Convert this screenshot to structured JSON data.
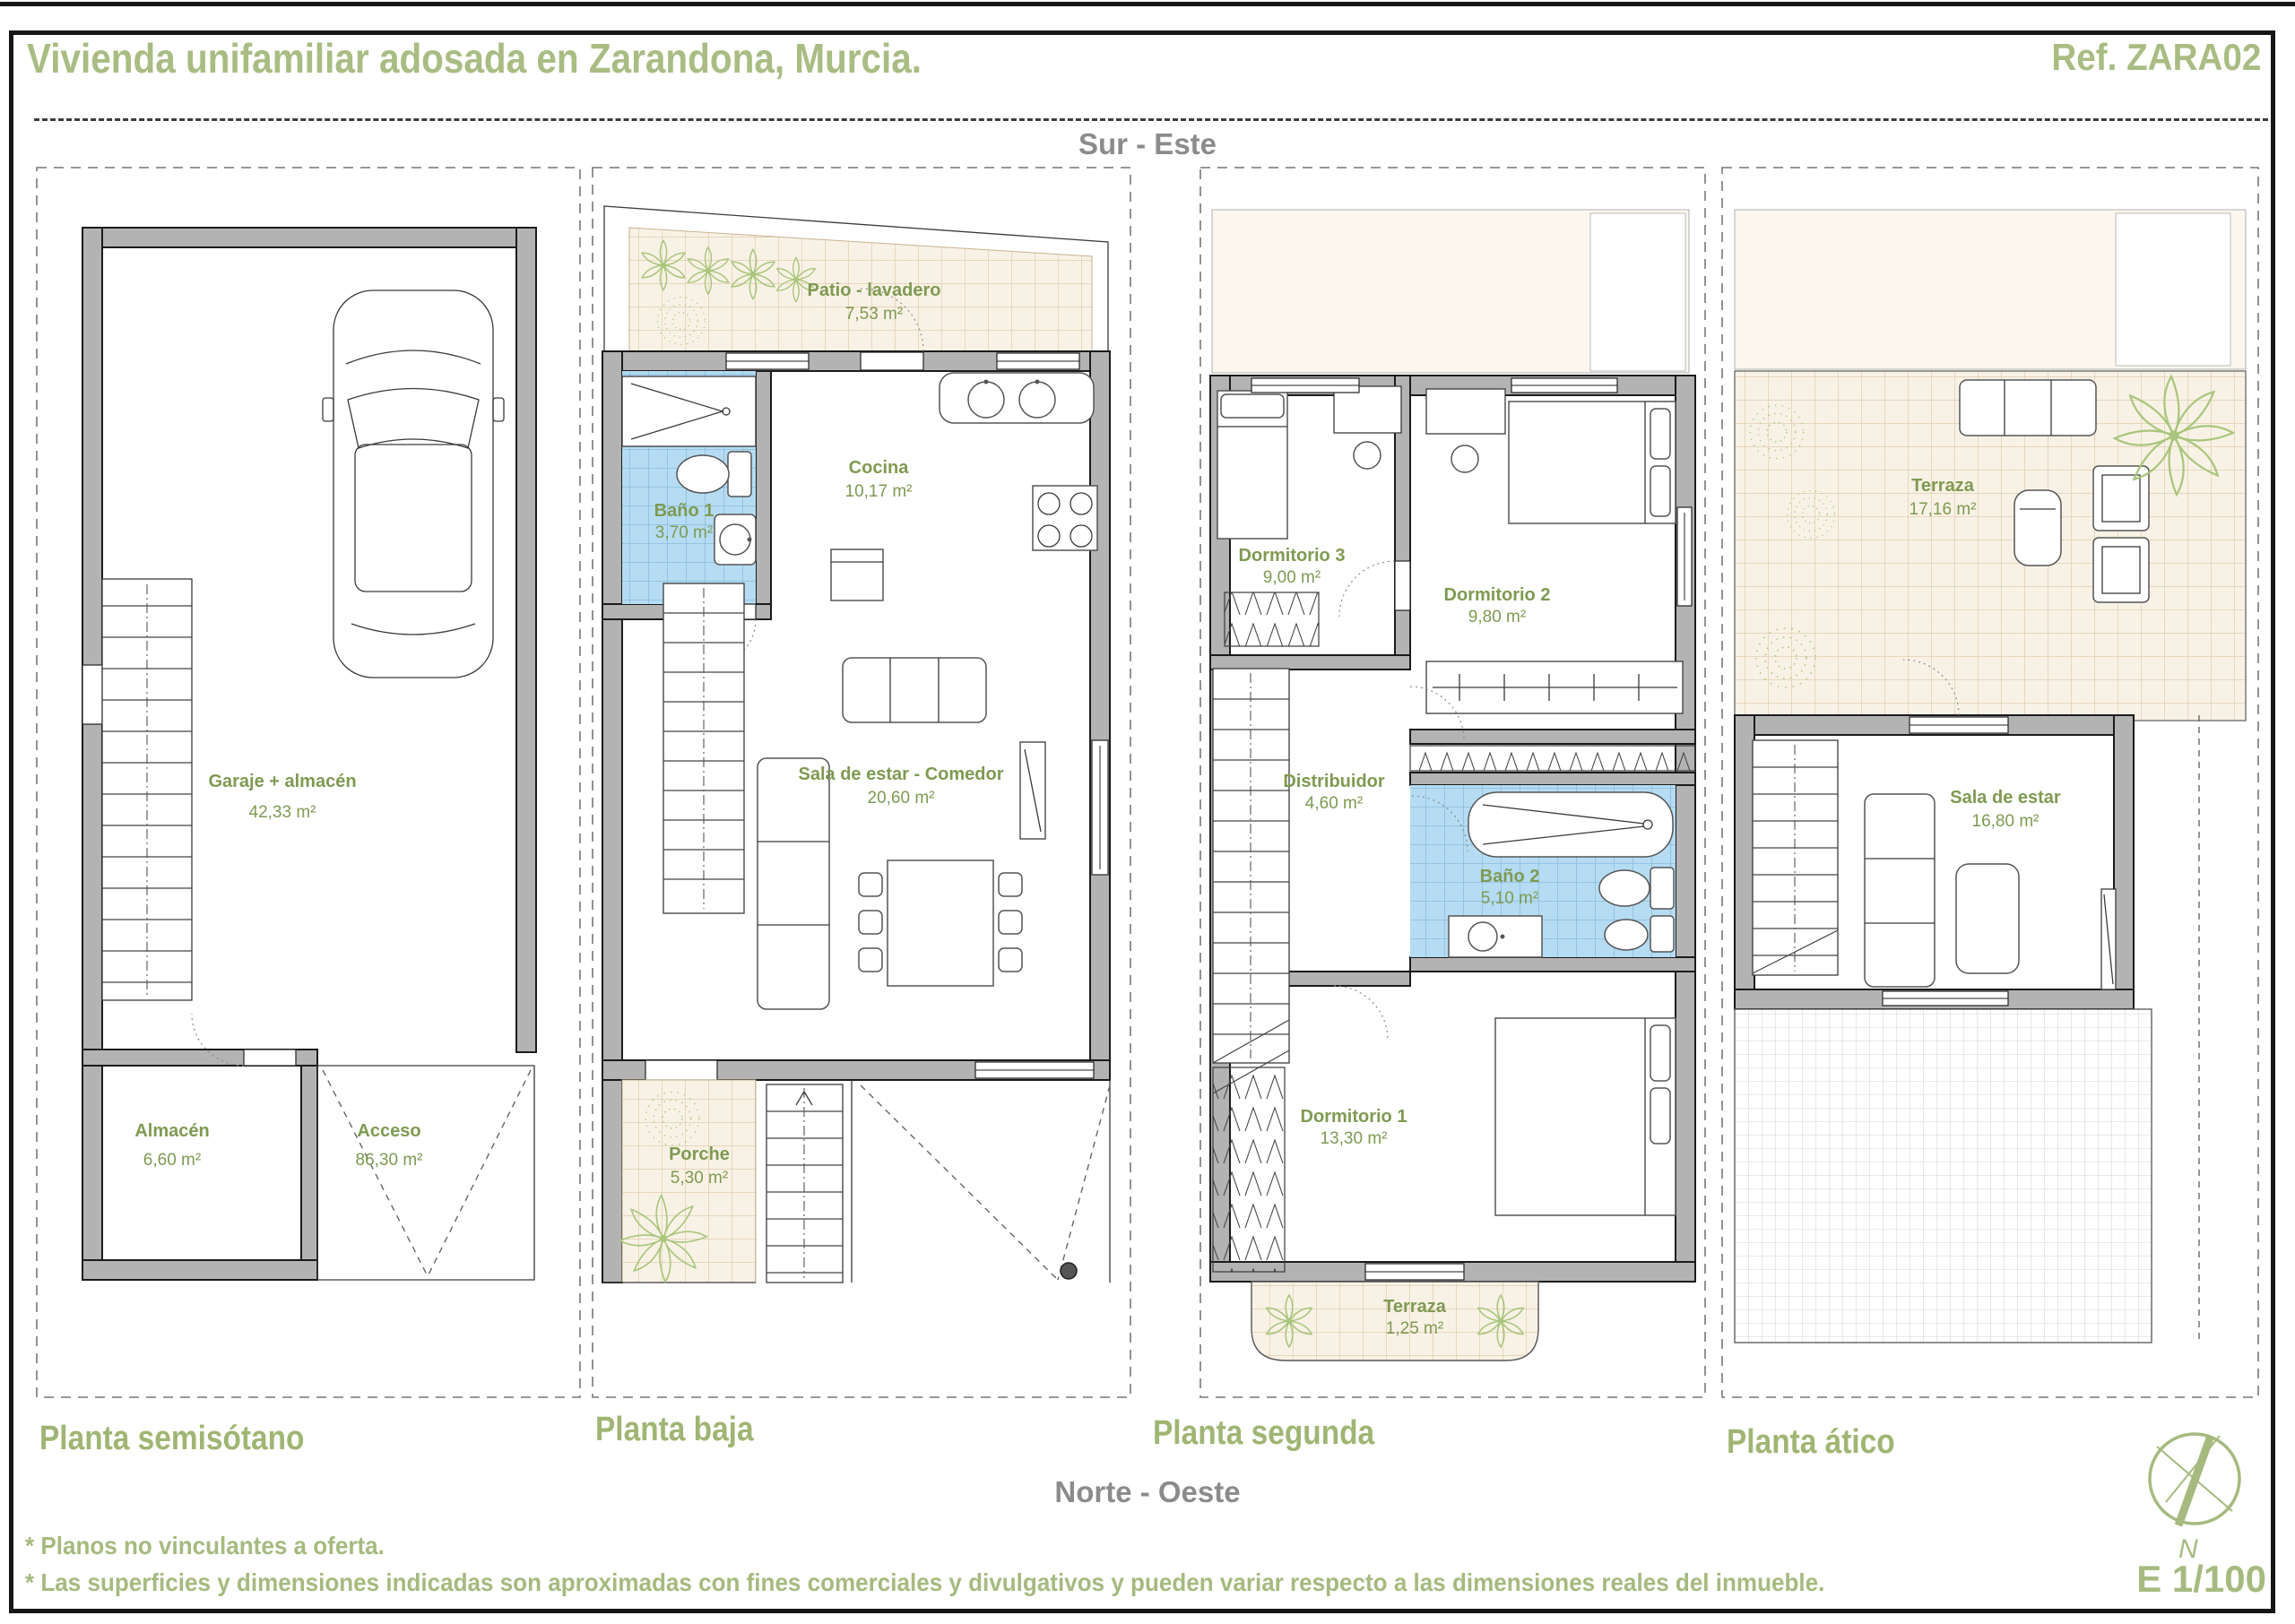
{
  "header": {
    "title": "Vivienda unifamiliar adosada en Zarandona, Murcia.",
    "reference": "Ref. ZARA02"
  },
  "orientation": {
    "top": "Sur - Este",
    "bottom": "Norte - Oeste"
  },
  "plans": [
    {
      "name": "Planta semisótano",
      "rooms": [
        {
          "label": "Garaje + almacén",
          "area": "42,33 m²"
        },
        {
          "label": "Almacén",
          "area": "6,60 m²"
        },
        {
          "label": "Acceso",
          "area": "86,30 m²"
        }
      ]
    },
    {
      "name": "Planta baja",
      "rooms": [
        {
          "label": "Patio - lavadero",
          "area": "7,53 m²"
        },
        {
          "label": "Baño 1",
          "area": "3,70 m²"
        },
        {
          "label": "Cocina",
          "area": "10,17 m²"
        },
        {
          "label": "Sala de estar - Comedor",
          "area": "20,60 m²"
        },
        {
          "label": "Porche",
          "area": "5,30 m²"
        }
      ]
    },
    {
      "name": "Planta segunda",
      "rooms": [
        {
          "label": "Dormitorio 3",
          "area": "9,00 m²"
        },
        {
          "label": "Dormitorio 2",
          "area": "9,80 m²"
        },
        {
          "label": "Distribuidor",
          "area": "4,60 m²"
        },
        {
          "label": "Baño 2",
          "area": "5,10 m²"
        },
        {
          "label": "Dormitorio 1",
          "area": "13,30 m²"
        },
        {
          "label": "Terraza",
          "area": "1,25 m²"
        }
      ]
    },
    {
      "name": "Planta ático",
      "rooms": [
        {
          "label": "Terraza",
          "area": "17,16 m²"
        },
        {
          "label": "Sala de estar",
          "area": "16,80 m²"
        }
      ]
    }
  ],
  "footnotes": [
    "* Planos no vinculantes a oferta.",
    "* Las superficies y dimensiones indicadas son aproximadas con fines comerciales y divulgativos y pueden variar respecto a las dimensiones reales del inmueble."
  ],
  "compass": {
    "north_label": "N"
  },
  "scale_label": "E 1/100",
  "colors": {
    "accent_green": "#a9bc82",
    "room_label_green": "#7f9a52",
    "muted_gray": "#8b8b8b",
    "wall_gray": "#b3b3b3",
    "bath_tile_blue": "#b5dcf2",
    "patio_tile_beige": "#f8f2e6"
  }
}
